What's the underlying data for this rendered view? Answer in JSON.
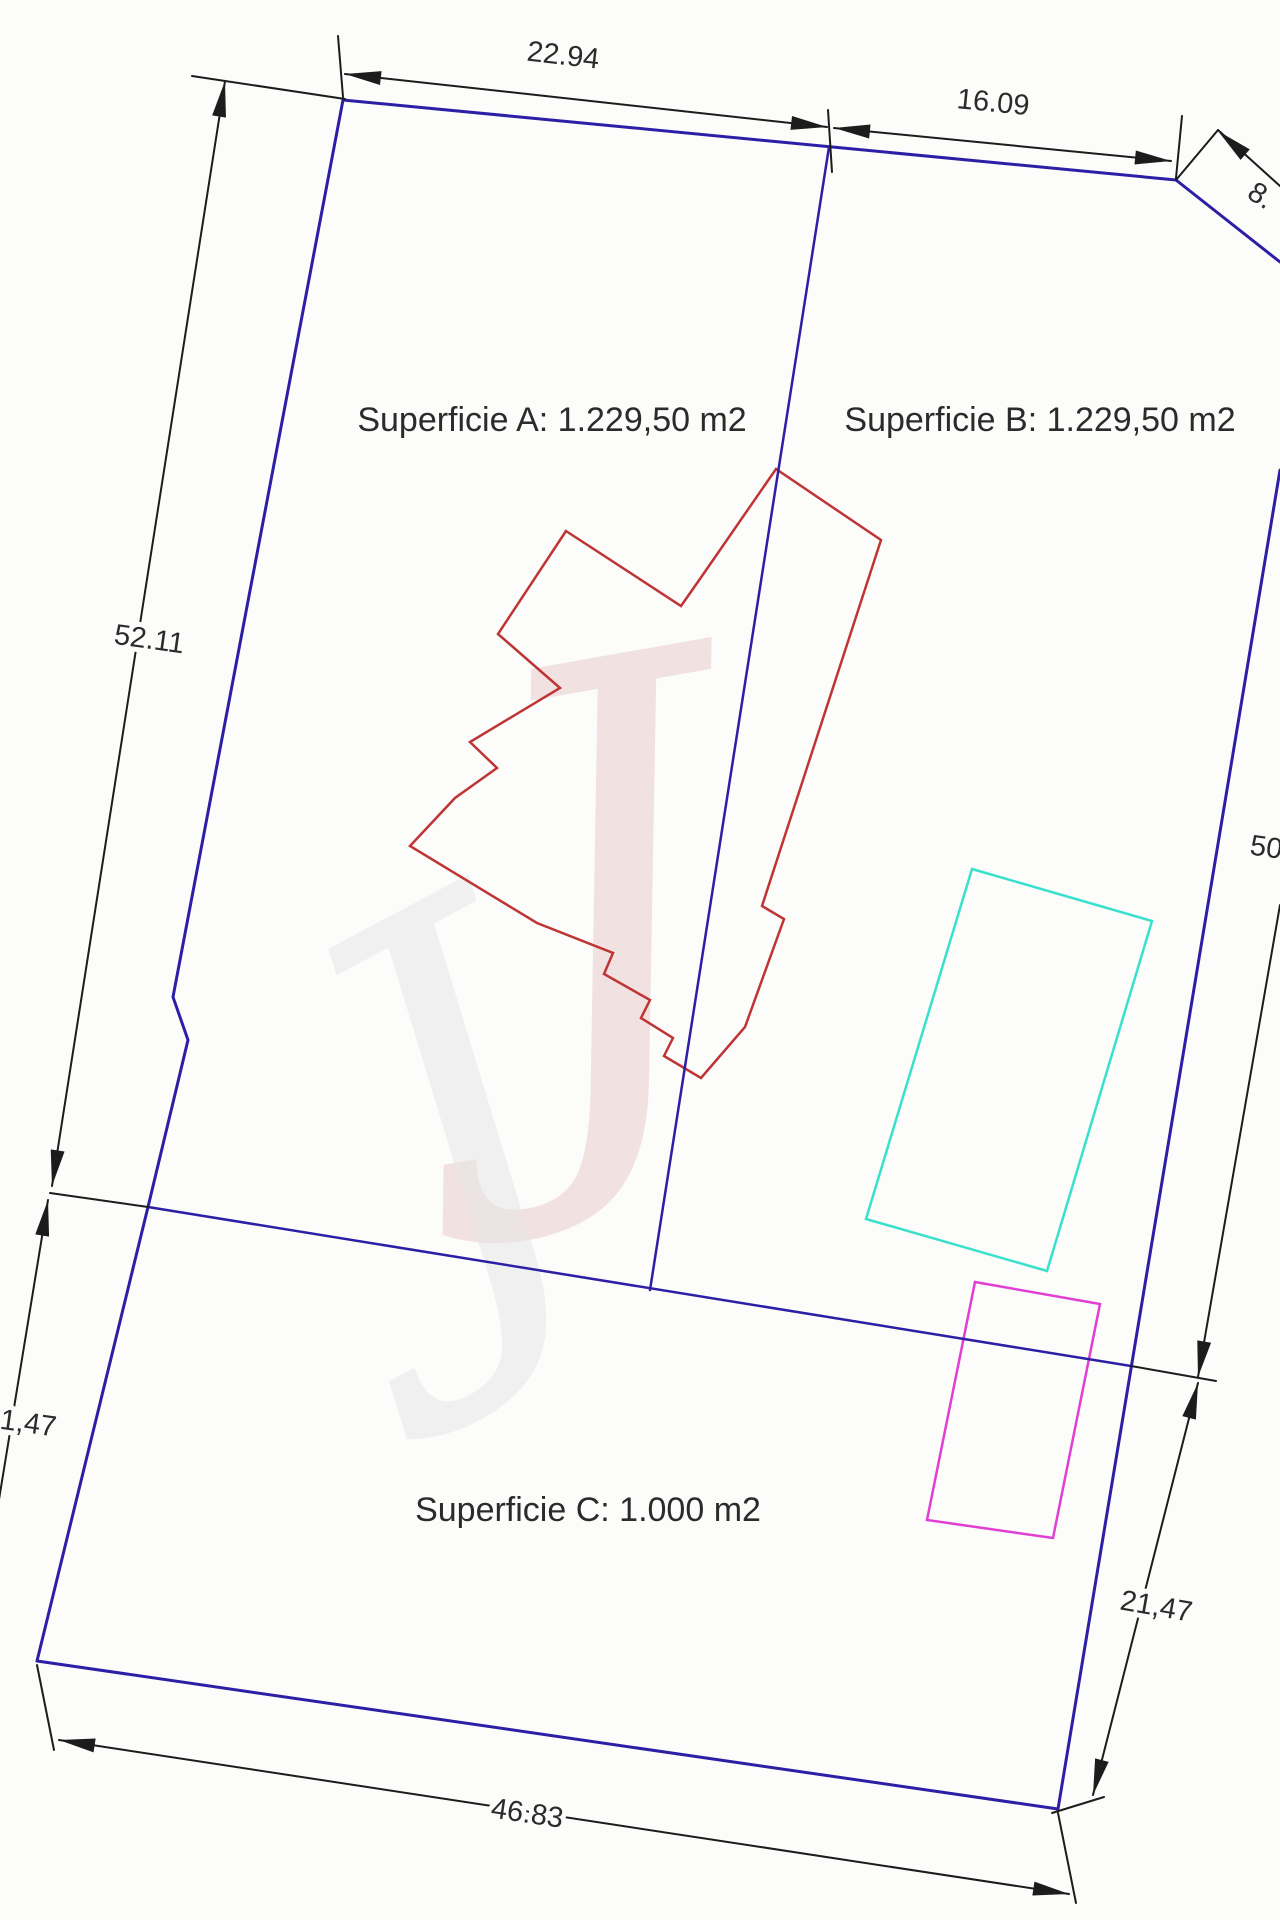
{
  "drawing": {
    "title_hint": "parcel subdivision plan",
    "colors": {
      "background": "#fcfcfb",
      "boundary_blue": "#2d1fa5",
      "dimension_black": "#1c1c1c",
      "building_red": "#bf3434",
      "pool_cyan": "#38e0cd",
      "rect_magenta": "#e13fd4",
      "label_text": "#2b2b2b"
    },
    "labels": [
      {
        "name": "dim-22-94",
        "text": "22.94",
        "x": 563,
        "y": 57,
        "rot": 6.5,
        "size": 29
      },
      {
        "name": "dim-16-09",
        "text": "16.09",
        "x": 993,
        "y": 104,
        "rot": 5.6,
        "size": 29
      },
      {
        "name": "dim-8",
        "text": "8.",
        "x": 1260,
        "y": 197,
        "rot": 33,
        "size": 29
      },
      {
        "name": "dim-52-11",
        "text": "52.11",
        "x": 149,
        "y": 641,
        "rot": 8,
        "size": 29
      },
      {
        "name": "dim-50",
        "text": "50",
        "x": 1266,
        "y": 849,
        "rot": 8,
        "size": 29
      },
      {
        "name": "dim-1-47",
        "text": "1,47",
        "x": 28,
        "y": 1425,
        "rot": 8,
        "size": 29
      },
      {
        "name": "dim-21-47-right",
        "text": "21,47",
        "x": 1156,
        "y": 1608,
        "rot": 10,
        "size": 29
      },
      {
        "name": "dim-46-83",
        "text": "46.83",
        "x": 527,
        "y": 1815,
        "rot": 8.5,
        "size": 29
      },
      {
        "name": "area-label-a",
        "text": "Superficie A: 1.229,50 m2",
        "x": 552,
        "y": 422,
        "rot": 0,
        "size": 34
      },
      {
        "name": "area-label-b",
        "text": "Superficie B: 1.229,50 m2",
        "x": 1040,
        "y": 422,
        "rot": 0,
        "size": 34
      },
      {
        "name": "area-label-c",
        "text": "Superficie C: 1.000 m2",
        "x": 588,
        "y": 1512,
        "rot": 0,
        "size": 34
      }
    ],
    "blue_lines": [
      {
        "name": "parcel-top-edge",
        "w": 3,
        "pts": [
          [
            343,
            100
          ],
          [
            1176,
            180
          ],
          [
            1280,
            262
          ]
        ]
      },
      {
        "name": "parcel-left-edge",
        "w": 3,
        "pts": [
          [
            343,
            100
          ],
          [
            173,
            997
          ],
          [
            188,
            1040
          ],
          [
            148,
            1207
          ],
          [
            37,
            1661
          ]
        ]
      },
      {
        "name": "parcel-bottom-edge",
        "w": 3,
        "pts": [
          [
            37,
            1661
          ],
          [
            1058,
            1809
          ]
        ]
      },
      {
        "name": "parcel-right-edge",
        "w": 3,
        "pts": [
          [
            1280,
            470
          ],
          [
            1058,
            1809
          ]
        ]
      },
      {
        "name": "boundary-ab-c",
        "w": 2.5,
        "pts": [
          [
            148,
            1207
          ],
          [
            1131,
            1366
          ]
        ]
      },
      {
        "name": "divider-a-b",
        "w": 2.5,
        "pts": [
          [
            829,
            147
          ],
          [
            650,
            1290
          ]
        ]
      }
    ],
    "black_lines": [
      {
        "name": "ext-topleft-up",
        "pts": [
          [
            343,
            97
          ],
          [
            338,
            36
          ]
        ]
      },
      {
        "name": "ext-topleft-left",
        "pts": [
          [
            192,
            76
          ],
          [
            345,
            99
          ]
        ]
      },
      {
        "name": "dimline-22-94",
        "pts": [
          [
            345,
            74
          ],
          [
            827,
            127
          ]
        ]
      },
      {
        "name": "ext-divider-top",
        "pts": [
          [
            828,
            110
          ],
          [
            832,
            172
          ]
        ]
      },
      {
        "name": "dimline-16-09",
        "pts": [
          [
            834,
            128
          ],
          [
            1171,
            161
          ]
        ]
      },
      {
        "name": "ext-topright-corner",
        "pts": [
          [
            1176,
            178
          ],
          [
            1182,
            116
          ]
        ]
      },
      {
        "name": "ext-chamfer",
        "pts": [
          [
            1176,
            180
          ],
          [
            1218,
            130
          ]
        ]
      },
      {
        "name": "dimline-8",
        "pts": [
          [
            1218,
            130
          ],
          [
            1280,
            186
          ]
        ]
      },
      {
        "name": "dimline-52-11",
        "pts": [
          [
            225,
            81
          ],
          [
            52,
            1186
          ]
        ]
      },
      {
        "name": "tick-left-junction",
        "pts": [
          [
            50,
            1193
          ],
          [
            148,
            1207
          ]
        ]
      },
      {
        "name": "dimline-1-47-left",
        "pts": [
          [
            48,
            1200
          ],
          [
            -6,
            1530
          ]
        ]
      },
      {
        "name": "dimline-50-right",
        "pts": [
          [
            1280,
            905
          ],
          [
            1198,
            1377
          ]
        ]
      },
      {
        "name": "tick-right-junction",
        "pts": [
          [
            1131,
            1366
          ],
          [
            1216,
            1381
          ]
        ]
      },
      {
        "name": "dimline-21-47-right",
        "pts": [
          [
            1198,
            1383
          ],
          [
            1093,
            1795
          ]
        ]
      },
      {
        "name": "ext-bottomright-tick",
        "pts": [
          [
            1052,
            1813
          ],
          [
            1104,
            1797
          ]
        ]
      },
      {
        "name": "ext-bottomleft-corner",
        "pts": [
          [
            37,
            1665
          ],
          [
            54,
            1750
          ]
        ]
      },
      {
        "name": "dimline-46-83",
        "pts": [
          [
            59,
            1740
          ],
          [
            1069,
            1894
          ]
        ]
      },
      {
        "name": "ext-bottomright-down",
        "pts": [
          [
            1058,
            1813
          ],
          [
            1076,
            1903
          ]
        ]
      }
    ],
    "arrows": [
      {
        "x": 345,
        "y": 74,
        "a": 186.5
      },
      {
        "x": 827,
        "y": 127,
        "a": 6.5
      },
      {
        "x": 834,
        "y": 128,
        "a": 185.6
      },
      {
        "x": 1171,
        "y": 161,
        "a": 5.6
      },
      {
        "x": 1218,
        "y": 131,
        "a": 221
      },
      {
        "x": 225,
        "y": 81,
        "a": 279.5
      },
      {
        "x": 52,
        "y": 1186,
        "a": 99
      },
      {
        "x": 48,
        "y": 1200,
        "a": 279.3
      },
      {
        "x": 1198,
        "y": 1377,
        "a": 99.9
      },
      {
        "x": 1198,
        "y": 1383,
        "a": 284.3
      },
      {
        "x": 1093,
        "y": 1795,
        "a": 104.3
      },
      {
        "x": 59,
        "y": 1740,
        "a": 188.7
      },
      {
        "x": 1069,
        "y": 1894,
        "a": 8.7
      }
    ],
    "building_red": {
      "name": "building-footprint",
      "pts": [
        [
          566,
          531
        ],
        [
          681,
          606
        ],
        [
          702,
          576
        ],
        [
          776,
          469
        ],
        [
          881,
          540
        ],
        [
          762,
          906
        ],
        [
          784,
          919
        ],
        [
          745,
          1027
        ],
        [
          701,
          1078
        ],
        [
          664,
          1056
        ],
        [
          673,
          1038
        ],
        [
          641,
          1018
        ],
        [
          650,
          1000
        ],
        [
          604,
          974
        ],
        [
          613,
          953
        ],
        [
          537,
          923
        ],
        [
          410,
          846
        ],
        [
          455,
          798
        ],
        [
          497,
          768
        ],
        [
          470,
          742
        ],
        [
          560,
          688
        ],
        [
          498,
          634
        ]
      ]
    },
    "pool_cyan": {
      "name": "cyan-rectangle",
      "pts": [
        [
          972,
          869
        ],
        [
          1152,
          921
        ],
        [
          1047,
          1271
        ],
        [
          866,
          1219
        ]
      ]
    },
    "rect_magenta": {
      "name": "magenta-rectangle",
      "pts": [
        [
          975,
          1282
        ],
        [
          1100,
          1304
        ],
        [
          1053,
          1538
        ],
        [
          927,
          1520
        ]
      ]
    },
    "watermarks": [
      {
        "name": "watermark-script-pink",
        "glyph": "J",
        "x": 615,
        "y": 940,
        "size": 600,
        "rot": -10,
        "color": "#e7c9c9",
        "opacity": 0.5
      },
      {
        "name": "watermark-script-gray",
        "glyph": "J",
        "x": 470,
        "y": 1150,
        "size": 520,
        "rot": -28,
        "color": "#e6e6e6",
        "opacity": 0.5
      }
    ]
  }
}
